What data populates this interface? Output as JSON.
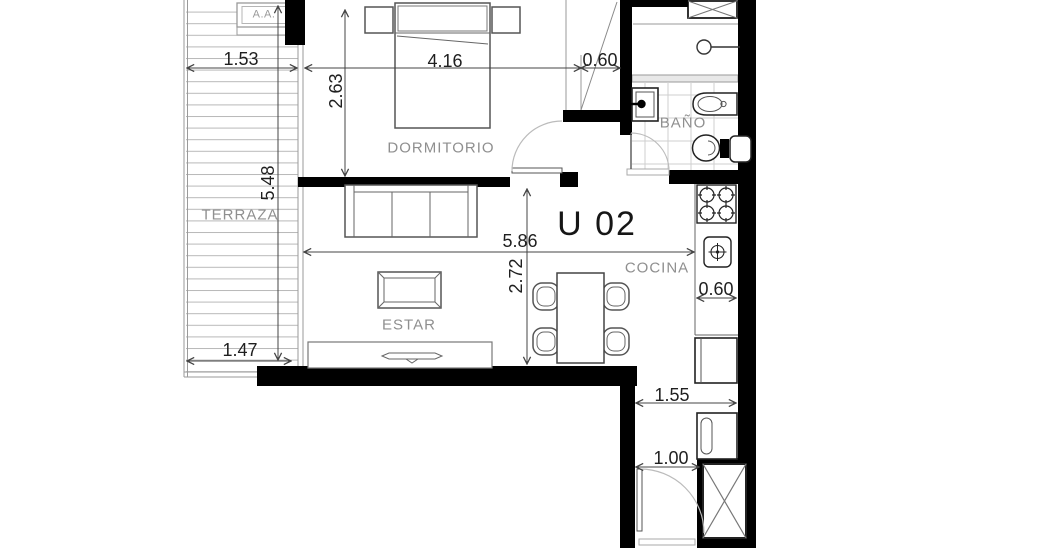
{
  "unit_label": "U 02",
  "rooms": {
    "terraza": "TERRAZA",
    "dormitorio": "DORMITORIO",
    "bano": "BAÑO",
    "estar": "ESTAR",
    "cocina": "COCINA"
  },
  "equipment": {
    "ac_unit": "A.A."
  },
  "dimensions": {
    "terraza_width": "1.53",
    "terraza_length": "5.48",
    "terraza_bottom_width": "1.47",
    "dormitorio_width": "4.16",
    "dormitorio_depth": "2.63",
    "closet_width": "0.60",
    "living_width": "5.86",
    "living_depth": "2.72",
    "counter_width": "0.60",
    "hall_width": "1.55",
    "entry_width": "1.00"
  },
  "colors": {
    "wall": "#000000",
    "room_label": "#8f8f8f",
    "dimension_text": "#1f1f1f",
    "furniture_line": "#555555",
    "deck_hatch": "#b8b8b8",
    "tile_grid": "#cfcfcf",
    "door_arc": "#bbbbbb",
    "background": "#ffffff"
  }
}
